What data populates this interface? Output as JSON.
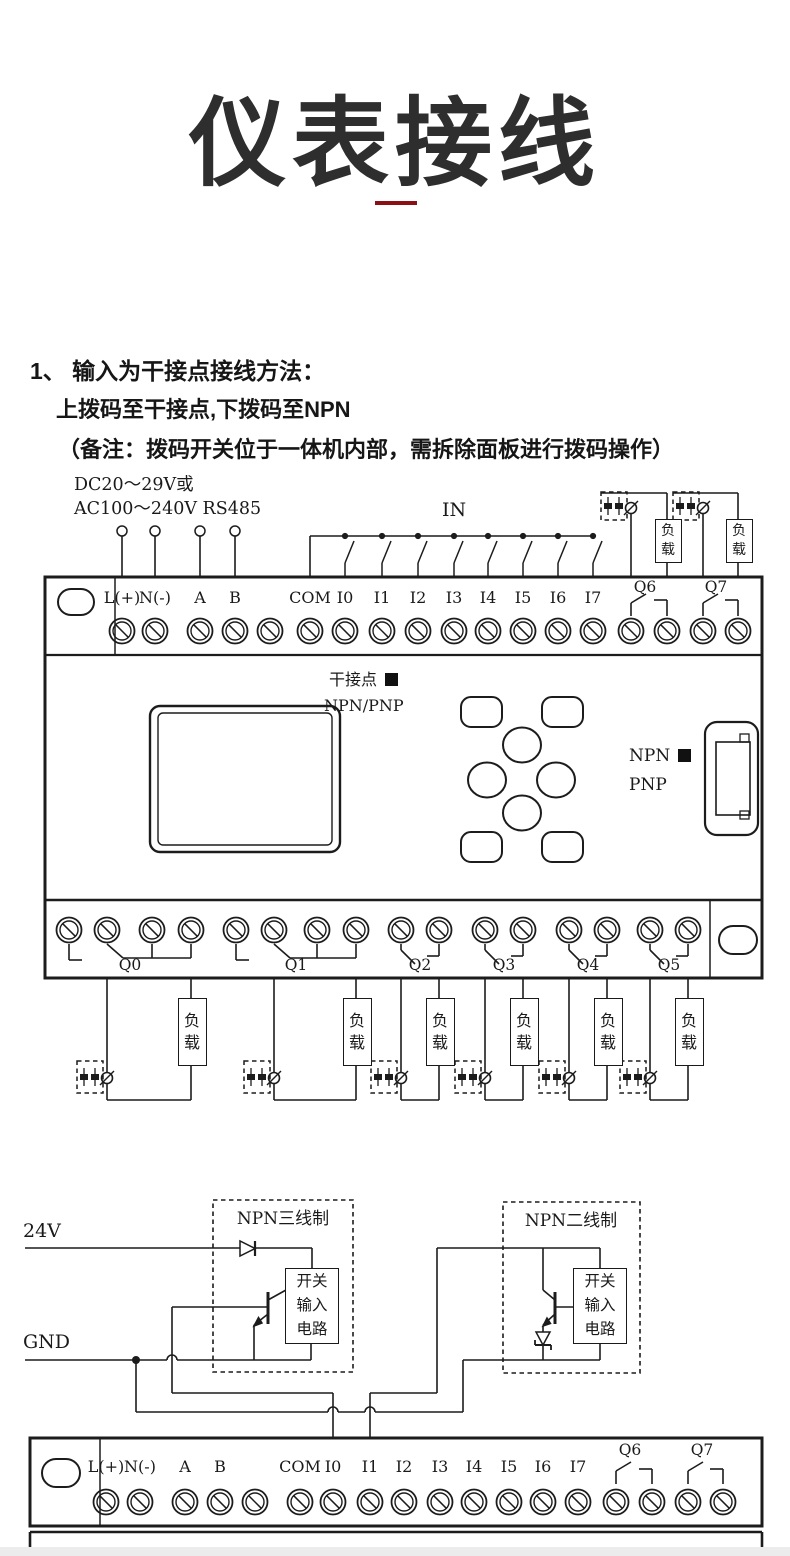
{
  "title": {
    "text": "仪表接线"
  },
  "colors": {
    "ink": "#1c1c1c",
    "accent_red": "#8b1016",
    "paper": "#ffffff"
  },
  "section1": {
    "heading": "1、 输入为干接点接线方法：",
    "line2": "上拨码至干接点,下拨码至NPN",
    "line3": "（备注：拨码开关位于一体机内部，需拆除面板进行拨码操作）"
  },
  "section2": {
    "heading": "2、 NPN接线方法：",
    "line2": "DC20～29V供电电源的NPN接线方法：上拨码至湿接点,下拨码至NPN"
  },
  "diagram1": {
    "power_label_line1": "DC20～29V或",
    "power_label_line2": "AC100～240V  RS485",
    "in_label": "IN",
    "input_terminals": [
      "L(+)",
      "N(-)",
      "A",
      "B",
      "COM",
      "I0",
      "I1",
      "I2",
      "I3",
      "I4",
      "I5",
      "I6",
      "I7"
    ],
    "relay_outputs_top": [
      "Q6",
      "Q7"
    ],
    "relay_outputs_bottom": [
      "Q0",
      "Q1",
      "Q2",
      "Q3",
      "Q4",
      "Q5"
    ],
    "load_label": "负载",
    "dip_switch1": {
      "label": "干接点",
      "sub": "NPN/PNP"
    },
    "dip_switch2": {
      "label": "NPN",
      "sub": "PNP"
    }
  },
  "diagram2": {
    "rail_24v": "24V",
    "rail_gnd": "GND",
    "sensor3_title": "NPN三线制",
    "sensor2_title": "NPN二线制",
    "circuit_box_lines": [
      "开关",
      "输入",
      "电路"
    ],
    "input_terminals": [
      "L(+)",
      "N(-)",
      "A",
      "B",
      "COM",
      "I0",
      "I1",
      "I2",
      "I3",
      "I4",
      "I5",
      "I6",
      "I7"
    ],
    "relay_outputs": [
      "Q6",
      "Q7"
    ]
  }
}
